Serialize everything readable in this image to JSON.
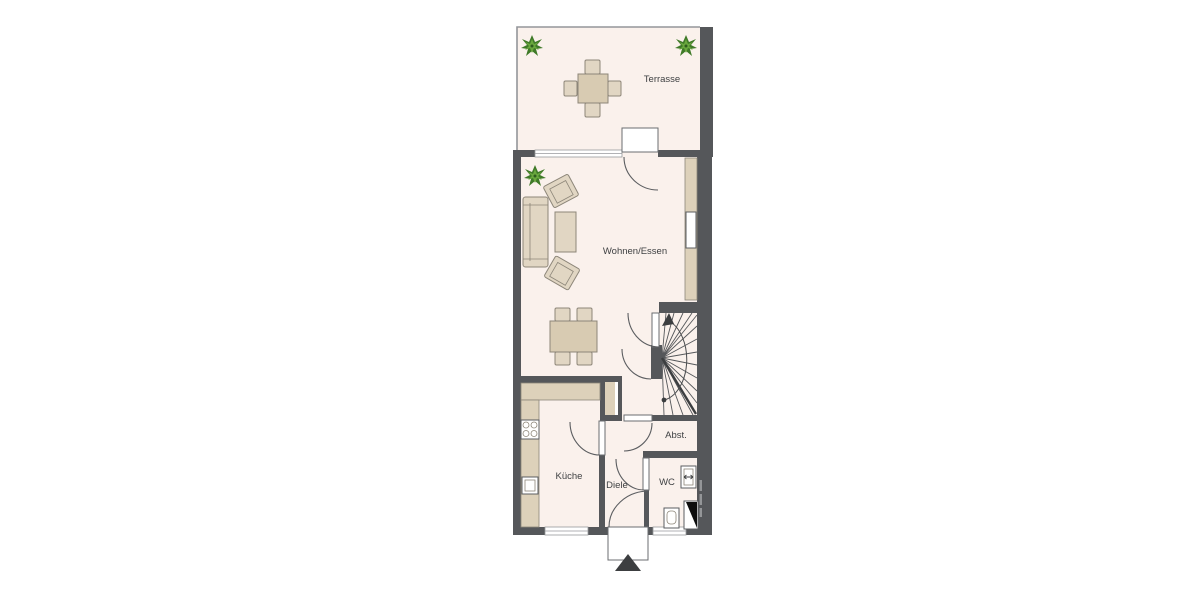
{
  "meta": {
    "type": "floor-plan",
    "floor": "ground-floor"
  },
  "labels": {
    "terrasse": "Terrasse",
    "wohnen_essen": "Wohnen/Essen",
    "kueche": "Küche",
    "diele": "Diele",
    "wc": "WC",
    "abstellraum": "Abst."
  },
  "colors": {
    "wall": "#55575a",
    "floor": "#faf1ec",
    "furniture": "#e1d6c3",
    "counter": "#ddd1ba",
    "plant_green_dark": "#3f7a28",
    "plant_green_light": "#6aa83e",
    "line": "#6b6d70",
    "text": "#3f4143",
    "background": "#ffffff"
  }
}
